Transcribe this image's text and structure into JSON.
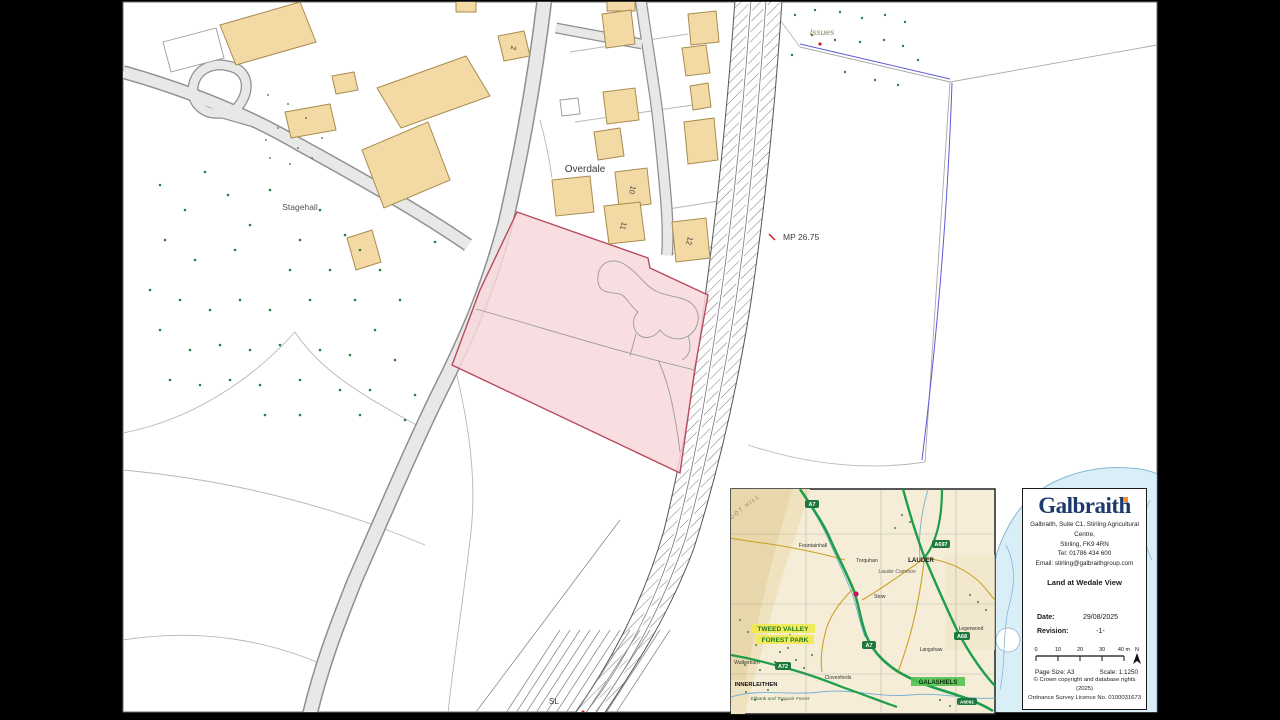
{
  "map": {
    "labels": {
      "overdale": "Overdale",
      "stagehall": "Stagehall",
      "milepost": "MP 26.75",
      "issues": "Issues",
      "sl": "SL",
      "num2": "2",
      "num10": "10",
      "num11": "11",
      "num12": "12"
    },
    "colors": {
      "sale_area_fill": "#f7d8dc",
      "sale_area_stroke": "#b94a5e",
      "building_fill": "#f3d9a4",
      "road_fill": "#e8e8e8",
      "tree_dot": "#2f7d3a",
      "water": "#daeef8"
    }
  },
  "inset": {
    "labels": {
      "dot_hill": "DOT HILL",
      "fountainhall": "Fountainhall",
      "torquhan": "Torquhan",
      "stow": "Stow",
      "lauder_common": "Lauder Common",
      "lauder": "LAUDER",
      "legerwood": "Legerwood",
      "langshaw": "Langshaw",
      "clovenfords": "Clovenfords",
      "walkerburn": "Walkerburn",
      "innerleithen": "INNERLEITHEN",
      "elibank": "Elibank and Traquair Forest",
      "galashiels": "GALASHIELS",
      "forest_park_1": "TWEED VALLEY",
      "forest_park_2": "FOREST PARK"
    },
    "shields": {
      "a7": "A7",
      "a697": "A697",
      "a68": "A68",
      "a7b": "A7",
      "a72": "A72",
      "a6091": "A6091"
    }
  },
  "titleblock": {
    "logo_text": "Galbraith",
    "address_line1": "Galbraith, Suite C1, Stirling Agricultural Centre,",
    "address_line2": "Stirling, FK9 4RN",
    "address_line3": "Tel: 01786 434 600",
    "address_line4": "Email: stirling@galbraithgroup.com",
    "plan_title": "Land at Wedale View",
    "date_label": "Date:",
    "date_value": "29/08/2025",
    "revision_label": "Revision:",
    "revision_value": "-1-",
    "scalebar": {
      "t0": "0",
      "t1": "10",
      "t2": "20",
      "t3": "30",
      "t4": "40 m",
      "north": "N"
    },
    "page_size": "Page Size: A3",
    "scale": "Scale: 1:1250",
    "copyright_line1": "© Crown copyright and database rights (2025)",
    "copyright_line2": "Ordnance Survey Licence No. 0100031673"
  }
}
